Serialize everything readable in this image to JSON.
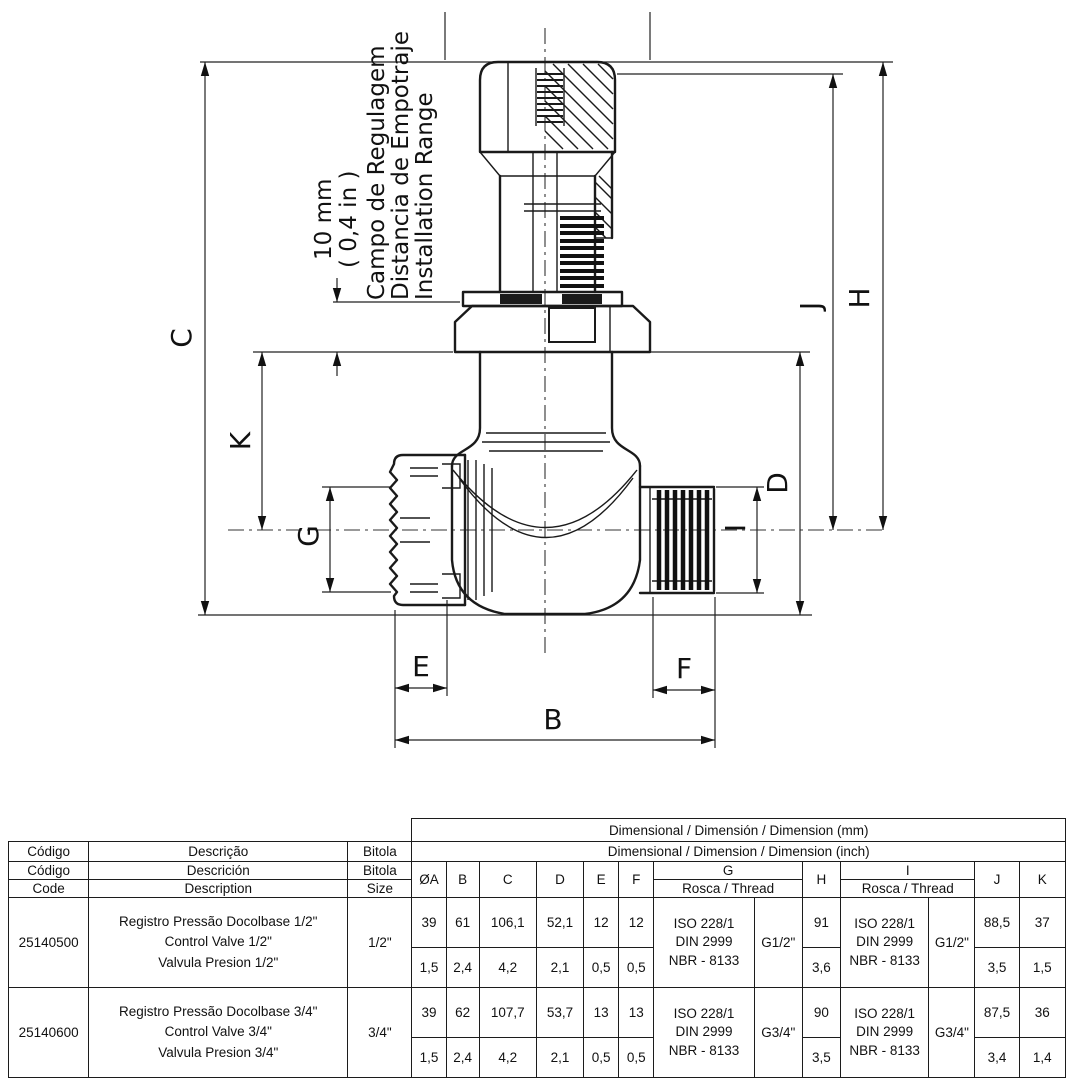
{
  "drawing": {
    "labels": {
      "c": "C",
      "k": "K",
      "g": "G",
      "e": "E",
      "f": "F",
      "b": "B",
      "d": "D",
      "i": "I",
      "j": "J",
      "h": "H"
    },
    "annotation": {
      "value_mm": "10 mm",
      "value_in": "( 0,4 in )",
      "line_pt": "Campo de Regulagem",
      "line_es": "Distancia de Empotraje",
      "line_en": "Installation Range"
    }
  },
  "table": {
    "header": {
      "mm_band": "Dimensional / Dimensión / Dimension (mm)",
      "inch_band": "Dimensional / Dimension / Dimension (inch)",
      "code": {
        "pt": "Código",
        "es": "Código",
        "en": "Code"
      },
      "description": {
        "pt": "Descrição",
        "es": "Descrición",
        "en": "Description"
      },
      "size": {
        "pt": "Bitola",
        "es": "Bitola",
        "en": "Size"
      },
      "cols": {
        "oa": "ØA",
        "b": "B",
        "c": "C",
        "d": "D",
        "e": "E",
        "f": "F",
        "g": "G",
        "h": "H",
        "i": "I",
        "j": "J",
        "k": "K"
      },
      "rosca": "Rosca / Thread"
    },
    "rows": [
      {
        "code": "25140500",
        "description": [
          "Registro Pressão Docolbase 1/2\"",
          "Control Valve 1/2\"",
          "Valvula Presion 1/2\""
        ],
        "size": "1/2\"",
        "mm": {
          "oa": "39",
          "b": "61",
          "c": "106,1",
          "d": "52,1",
          "e": "12",
          "f": "12",
          "h": "91",
          "j": "88,5",
          "k": "37"
        },
        "inch": {
          "oa": "1,5",
          "b": "2,4",
          "c": "4,2",
          "d": "2,1",
          "e": "0,5",
          "f": "0,5",
          "h": "3,6",
          "j": "3,5",
          "k": "1,5"
        },
        "g_thread": [
          "ISO 228/1",
          "DIN 2999",
          "NBR - 8133"
        ],
        "g_size": "G1/2\"",
        "i_thread": [
          "ISO 228/1",
          "DIN 2999",
          "NBR - 8133"
        ],
        "i_size": "G1/2\""
      },
      {
        "code": "25140600",
        "description": [
          "Registro Pressão Docolbase 3/4\"",
          "Control Valve 3/4\"",
          "Valvula Presion 3/4\""
        ],
        "size": "3/4\"",
        "mm": {
          "oa": "39",
          "b": "62",
          "c": "107,7",
          "d": "53,7",
          "e": "13",
          "f": "13",
          "h": "90",
          "j": "87,5",
          "k": "36"
        },
        "inch": {
          "oa": "1,5",
          "b": "2,4",
          "c": "4,2",
          "d": "2,1",
          "e": "0,5",
          "f": "0,5",
          "h": "3,5",
          "j": "3,4",
          "k": "1,4"
        },
        "g_thread": [
          "ISO 228/1",
          "DIN 2999",
          "NBR - 8133"
        ],
        "g_size": "G3/4\"",
        "i_thread": [
          "ISO 228/1",
          "DIN 2999",
          "NBR - 8133"
        ],
        "i_size": "G3/4\""
      }
    ]
  }
}
